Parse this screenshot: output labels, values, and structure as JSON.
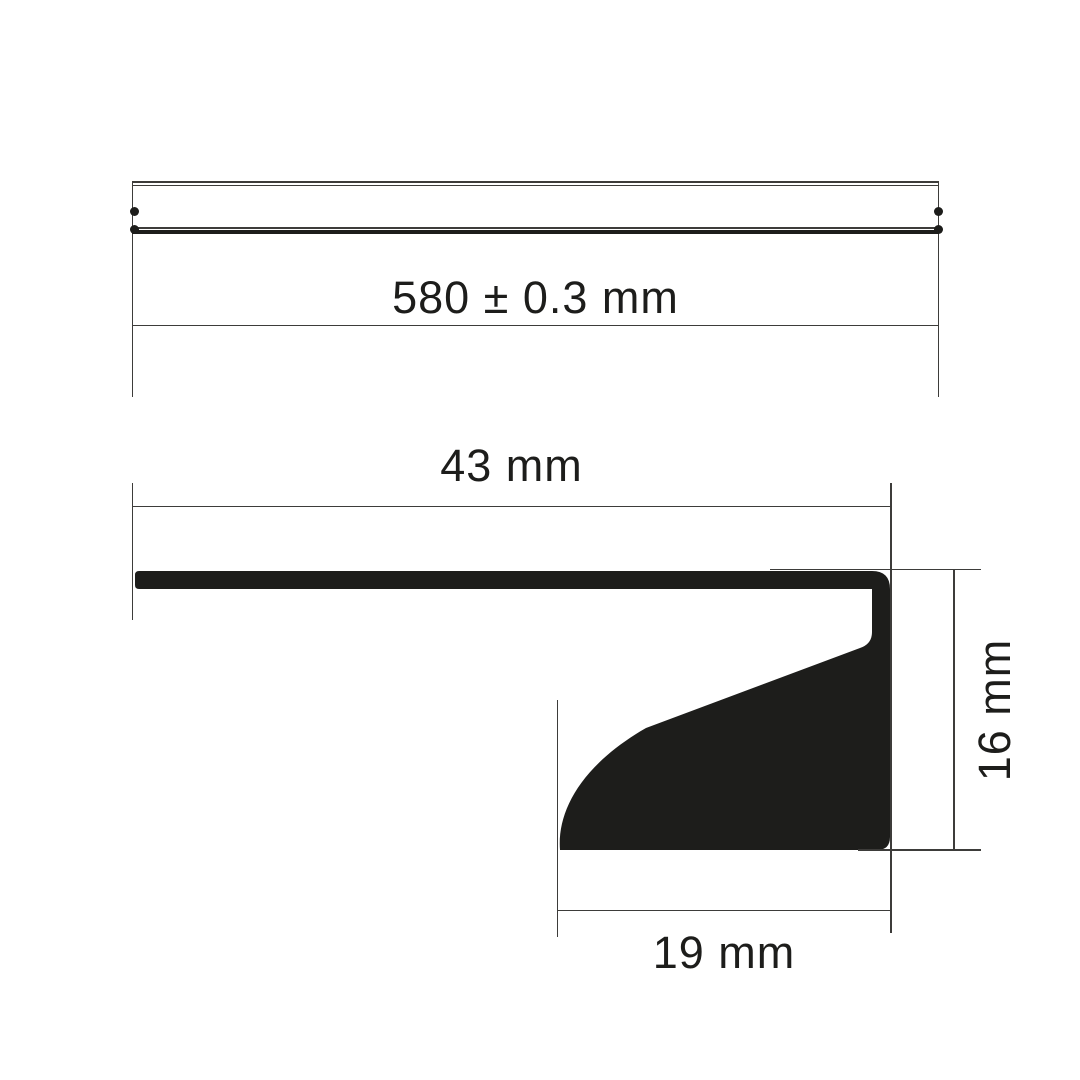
{
  "labels": {
    "length": "580 ± 0.3 mm",
    "overall_width": "43 mm",
    "front_height": "16 mm",
    "bottom_depth": "19 mm"
  },
  "dimensions": [
    {
      "axis": "length",
      "value": 580,
      "tolerance": 0.3,
      "unit": "mm",
      "orientation": "horizontal"
    },
    {
      "axis": "width",
      "value": 43,
      "unit": "mm",
      "orientation": "horizontal"
    },
    {
      "axis": "height",
      "value": 16,
      "unit": "mm",
      "orientation": "vertical"
    },
    {
      "axis": "depth",
      "value": 19,
      "unit": "mm",
      "orientation": "horizontal"
    }
  ],
  "colors": {
    "background": "#ffffff",
    "line": "#3d3c3a",
    "ink": "#1d1d1b"
  }
}
